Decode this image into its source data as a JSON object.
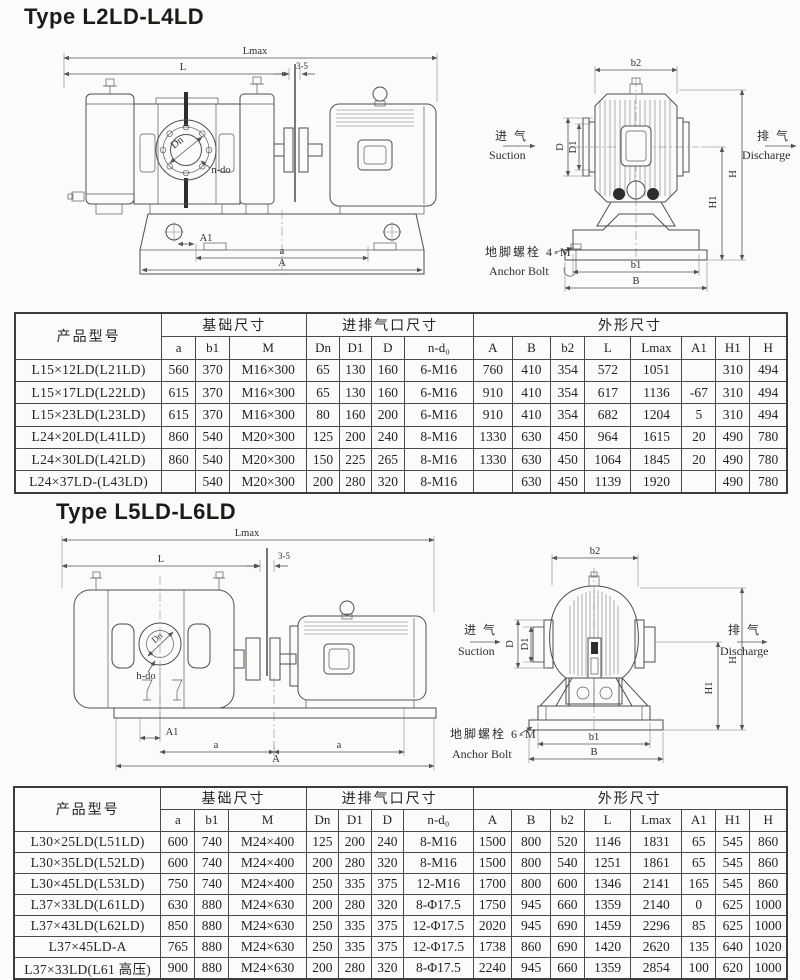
{
  "sections": [
    {
      "title": "Type L2LD-L4LD",
      "side_view": {
        "lmax": "Lmax",
        "l": "L",
        "gap": "3-5",
        "dn": "Dn",
        "ndo": "n-do",
        "a1": "A1",
        "a": "a",
        "total": "A"
      },
      "end_view": {
        "b2": "b2",
        "suction_cn": "进 气",
        "suction_en": "Suction",
        "discharge_cn": "排 气",
        "discharge_en": "Discharge",
        "d": "D",
        "d1": "D1",
        "h": "H",
        "h1": "H1",
        "anchor_cn": "地脚螺栓 4-M",
        "anchor_en": "Anchor Bolt",
        "b1": "b1",
        "b": "B"
      },
      "table": {
        "col_model": "产品型号",
        "groups": [
          {
            "label": "基础尺寸",
            "span": 3
          },
          {
            "label": "进排气口尺寸",
            "span": 4
          },
          {
            "label": "外形尺寸",
            "span": 8
          }
        ],
        "columns": [
          "a",
          "b1",
          "M",
          "Dn",
          "D1",
          "D",
          "n-d₀",
          "A",
          "B",
          "b2",
          "L",
          "Lmax",
          "A1",
          "H1",
          "H"
        ],
        "rows": [
          {
            "model": "L15×12LD(L21LD)",
            "values": [
              "560",
              "370",
              "M16×300",
              "65",
              "130",
              "160",
              "6-M16",
              "760",
              "410",
              "354",
              "572",
              "1051",
              "",
              "310",
              "494"
            ]
          },
          {
            "model": "L15×17LD(L22LD)",
            "values": [
              "615",
              "370",
              "M16×300",
              "65",
              "130",
              "160",
              "6-M16",
              "910",
              "410",
              "354",
              "617",
              "1136",
              "-67",
              "310",
              "494"
            ]
          },
          {
            "model": "L15×23LD(L23LD)",
            "values": [
              "615",
              "370",
              "M16×300",
              "80",
              "160",
              "200",
              "6-M16",
              "910",
              "410",
              "354",
              "682",
              "1204",
              "5",
              "310",
              "494"
            ]
          },
          {
            "model": "L24×20LD(L41LD)",
            "values": [
              "860",
              "540",
              "M20×300",
              "125",
              "200",
              "240",
              "8-M16",
              "1330",
              "630",
              "450",
              "964",
              "1615",
              "20",
              "490",
              "780"
            ]
          },
          {
            "model": "L24×30LD(L42LD)",
            "values": [
              "860",
              "540",
              "M20×300",
              "150",
              "225",
              "265",
              "8-M16",
              "1330",
              "630",
              "450",
              "1064",
              "1845",
              "20",
              "490",
              "780"
            ]
          },
          {
            "model": "L24×37LD-(L43LD)",
            "values": [
              "",
              "540",
              "M20×300",
              "200",
              "280",
              "320",
              "8-M16",
              "",
              "630",
              "450",
              "1139",
              "1920",
              "",
              "490",
              "780"
            ]
          }
        ]
      }
    },
    {
      "title": "Type L5LD-L6LD",
      "side_view": {
        "lmax": "Lmax",
        "l": "L",
        "gap": "3-5",
        "dn": "Dn",
        "ndo": "h-do",
        "a1": "A1",
        "a": "a",
        "total": "A"
      },
      "end_view": {
        "b2": "b2",
        "suction_cn": "进 气",
        "suction_en": "Suction",
        "discharge_cn": "排 气",
        "discharge_en": "Discharge",
        "d": "D",
        "d1": "D1",
        "h": "H",
        "h1": "H1",
        "anchor_cn": "地脚螺栓 6-M",
        "anchor_en": "Anchor Bolt",
        "b1": "b1",
        "b": "B"
      },
      "table": {
        "col_model": "产品型号",
        "groups": [
          {
            "label": "基础尺寸",
            "span": 3
          },
          {
            "label": "进排气口尺寸",
            "span": 4
          },
          {
            "label": "外形尺寸",
            "span": 8
          }
        ],
        "columns": [
          "a",
          "b1",
          "M",
          "Dn",
          "D1",
          "D",
          "n-d₀",
          "A",
          "B",
          "b2",
          "L",
          "Lmax",
          "A1",
          "H1",
          "H"
        ],
        "rows": [
          {
            "model": "L30×25LD(L51LD)",
            "values": [
              "600",
              "740",
              "M24×400",
              "125",
              "200",
              "240",
              "8-M16",
              "1500",
              "800",
              "520",
              "1146",
              "1831",
              "65",
              "545",
              "860"
            ]
          },
          {
            "model": "L30×35LD(L52LD)",
            "values": [
              "600",
              "740",
              "M24×400",
              "200",
              "280",
              "320",
              "8-M16",
              "1500",
              "800",
              "540",
              "1251",
              "1861",
              "65",
              "545",
              "860"
            ]
          },
          {
            "model": "L30×45LD(L53LD)",
            "values": [
              "750",
              "740",
              "M24×400",
              "250",
              "335",
              "375",
              "12-M16",
              "1700",
              "800",
              "600",
              "1346",
              "2141",
              "165",
              "545",
              "860"
            ]
          },
          {
            "model": "L37×33LD(L61LD)",
            "values": [
              "630",
              "880",
              "M24×630",
              "200",
              "280",
              "320",
              "8-Φ17.5",
              "1750",
              "945",
              "660",
              "1359",
              "2140",
              "0",
              "625",
              "1000"
            ]
          },
          {
            "model": "L37×43LD(L62LD)",
            "values": [
              "850",
              "880",
              "M24×630",
              "250",
              "335",
              "375",
              "12-Φ17.5",
              "2020",
              "945",
              "690",
              "1459",
              "2296",
              "85",
              "625",
              "1000"
            ]
          },
          {
            "model": "L37×45LD-A",
            "values": [
              "765",
              "880",
              "M24×630",
              "250",
              "335",
              "375",
              "12-Φ17.5",
              "1738",
              "860",
              "690",
              "1420",
              "2620",
              "135",
              "640",
              "1020"
            ]
          },
          {
            "model": "L37×33LD(L61 高压)",
            "values": [
              "900",
              "880",
              "M24×630",
              "200",
              "280",
              "320",
              "8-Φ17.5",
              "2240",
              "945",
              "660",
              "1359",
              "2854",
              "100",
              "620",
              "1000"
            ]
          }
        ]
      }
    }
  ]
}
